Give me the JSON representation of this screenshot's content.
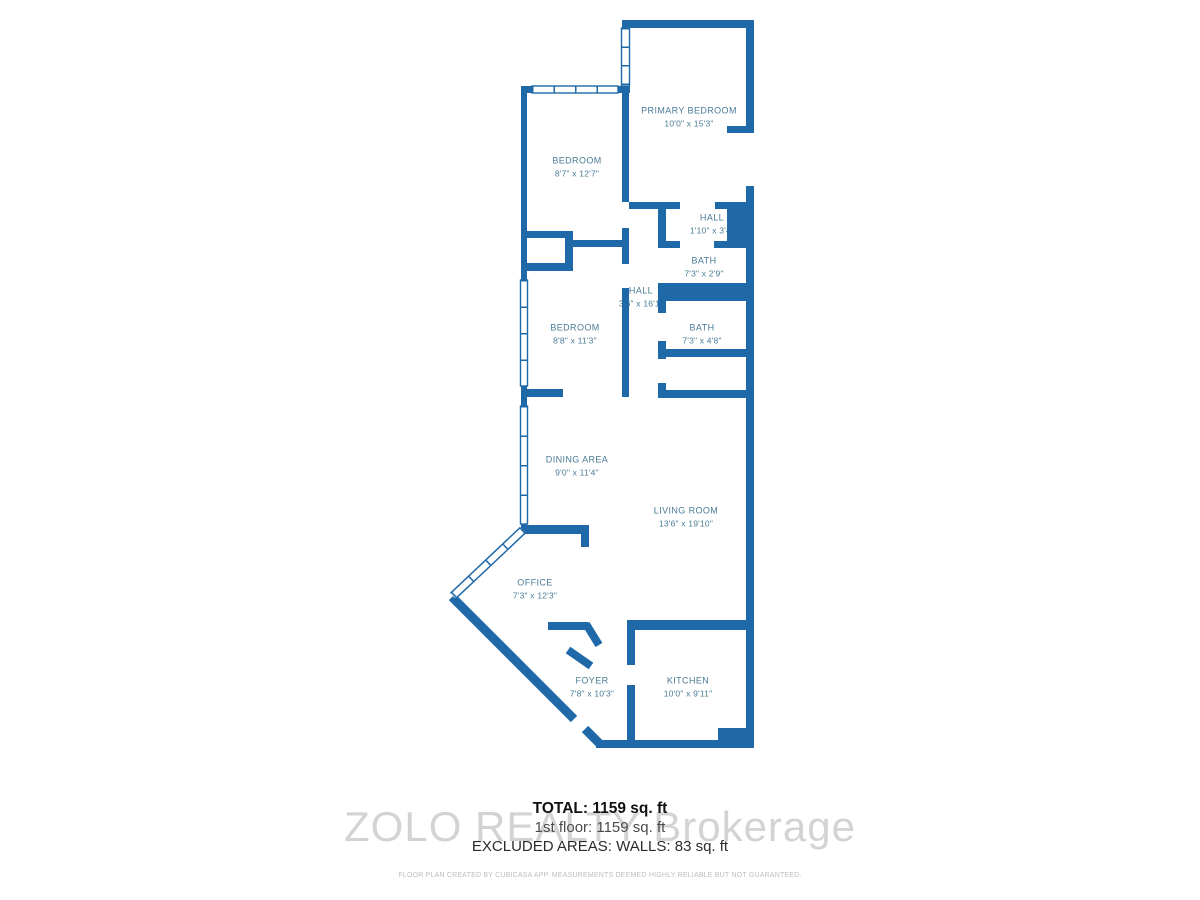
{
  "plan": {
    "rooms": [
      {
        "name": "PRIMARY BEDROOM",
        "dims": "10'0\" x 15'3\""
      },
      {
        "name": "BEDROOM",
        "dims": "8'7\" x 12'7\""
      },
      {
        "name": "HALL",
        "dims": "1'10\" x 3'4\""
      },
      {
        "name": "BATH",
        "dims": "7'3\" x 2'9\""
      },
      {
        "name": "HALL",
        "dims": "3'6\" x 16'1\""
      },
      {
        "name": "BEDROOM",
        "dims": "8'8\" x 11'3\""
      },
      {
        "name": "BATH",
        "dims": "7'3\" x 4'8\""
      },
      {
        "name": "DINING AREA",
        "dims": "9'0\" x 11'4\""
      },
      {
        "name": "LIVING ROOM",
        "dims": "13'6\" x 19'10\""
      },
      {
        "name": "OFFICE",
        "dims": "7'3\" x 12'3\""
      },
      {
        "name": "FOYER",
        "dims": "7'8\" x 10'3\""
      },
      {
        "name": "KITCHEN",
        "dims": "10'0\" x 9'11\""
      }
    ],
    "colors": {
      "wall": "#2069a8",
      "room_label": "#4a7b96",
      "watermark": "#c9c9c9"
    }
  },
  "summary": {
    "total": "TOTAL: 1159 sq. ft",
    "first_floor": "1st floor: 1159 sq. ft",
    "excluded": "EXCLUDED AREAS: WALLS: 83 sq. ft"
  },
  "watermark": "ZOLO REALTY Brokerage",
  "disclaimer": "FLOOR PLAN CREATED BY CUBICASA APP. MEASUREMENTS DEEMED HIGHLY RELIABLE BUT NOT GUARANTEED."
}
